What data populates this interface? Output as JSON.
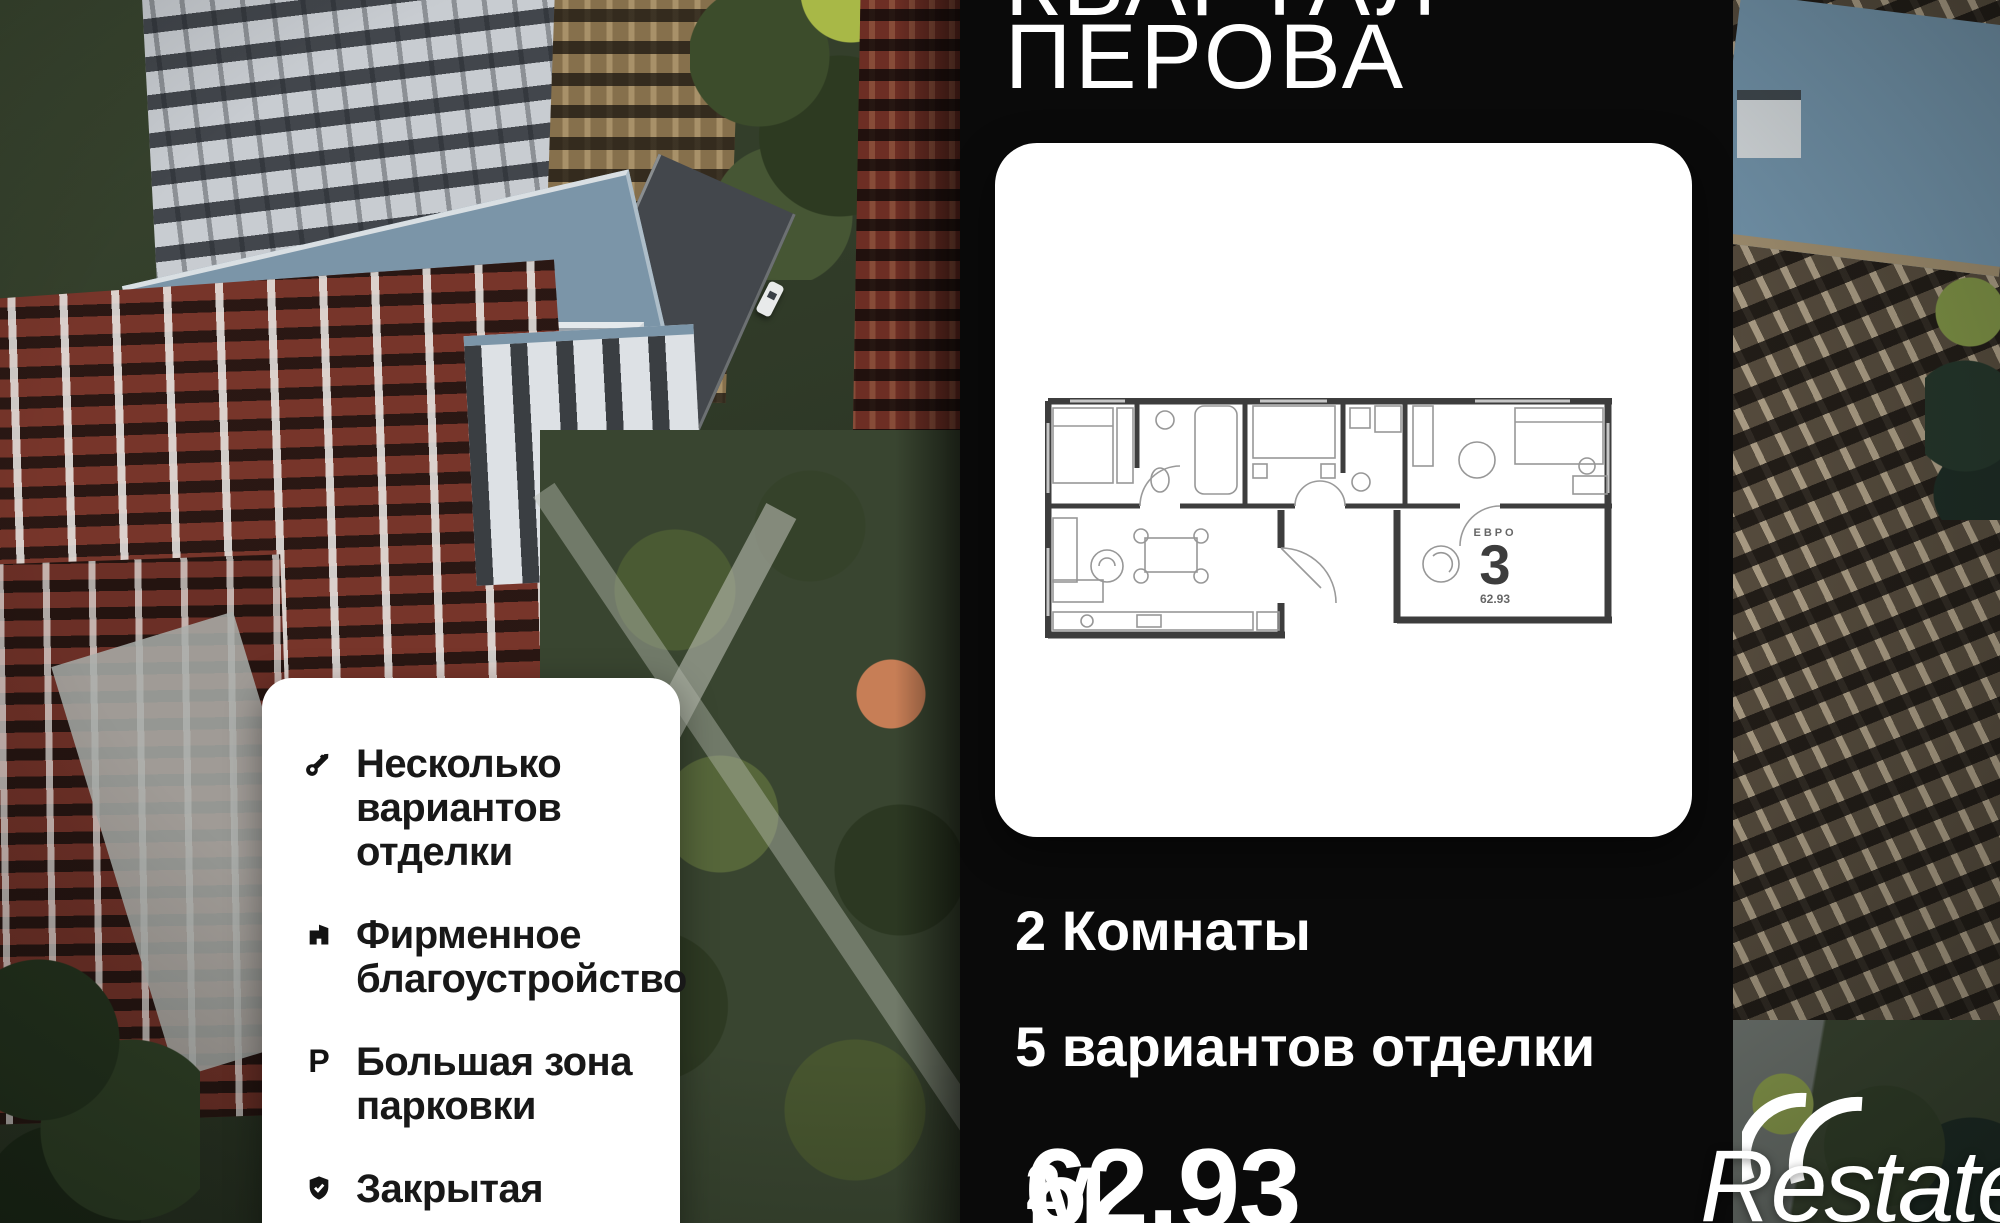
{
  "title": {
    "line1_cropped": "КВАРТАЛ",
    "line2": "ПЕРОВА"
  },
  "plan_card": {
    "badge_type": "ЕВРО",
    "badge_rooms": "3",
    "badge_area": "62.93"
  },
  "features": [
    {
      "icon": "key-icon",
      "label": "Несколько\nвариантов отделки"
    },
    {
      "icon": "building-icon",
      "label": "Фирменное\nблагоустройство"
    },
    {
      "icon": "parking-icon",
      "icon_letter": "P",
      "label": "Большая зона\nпарковки"
    },
    {
      "icon": "shield-check-icon",
      "label": "Закрытая\nтерритория"
    }
  ],
  "summary": {
    "rooms": "2 Комнаты",
    "finishes": "5 вариантов отделки",
    "area_value": "62.93",
    "area_unit": " м",
    "area_superscript": "2"
  },
  "brand": {
    "name": "Restate"
  },
  "colors": {
    "panel_background": "#0a0a0a",
    "card_background": "#ffffff",
    "panel_text": "#ffffff",
    "card_text": "#181818",
    "plan_wall": "#3d3d3d"
  }
}
